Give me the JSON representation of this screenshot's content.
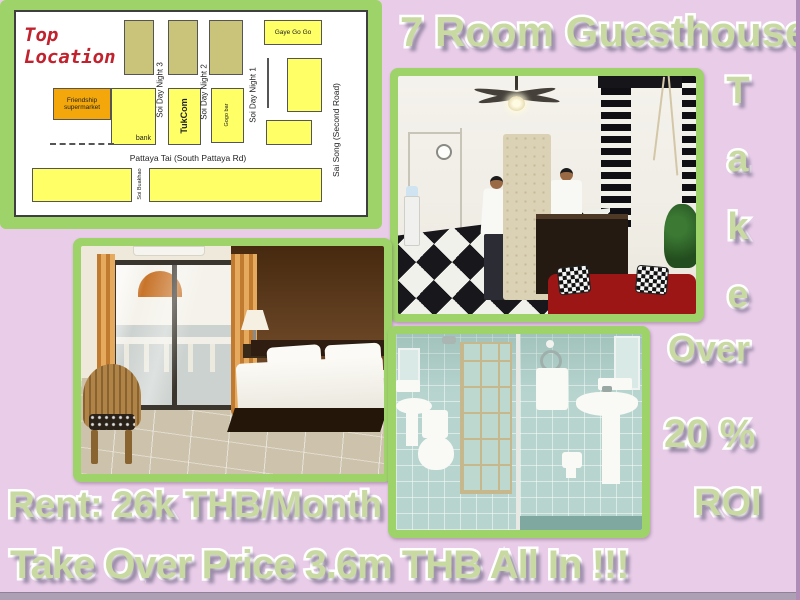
{
  "header": {
    "title": "7 Room Guesthouse"
  },
  "side": {
    "take_letters": [
      "T",
      "a",
      "k",
      "e"
    ],
    "over": "Over",
    "percent": "20 %",
    "roi": "ROI"
  },
  "footer": {
    "rent": "Rent: 26k THB/Month",
    "price": "Take Over Price 3.6m THB All In !!!"
  },
  "map": {
    "title_line1": "Top",
    "title_line2": "Location",
    "labels": {
      "gaye_go_go": "Gaye Go Go",
      "friendship_line1": "Friendship",
      "friendship_line2": "supermarket",
      "bank": "bank",
      "tukcom": "TukCom",
      "gogo_bar": "Gogo bar",
      "soi_day_night_3": "Soi Day Night 3",
      "soi_day_night_2": "Soi Day Night 2",
      "soi_day_night_1": "Soi Day Night 1",
      "pattaya_tai": "Pattaya Tai (South Pattaya Rd)",
      "sai_song": "Sai Song (Second Road)",
      "soi_buakhao": "Soi Buakhao"
    }
  },
  "colors": {
    "background": "#e8cce8",
    "frame_green": "#9ed36a",
    "text_green": "#c9d9a2",
    "map_yellow": "#ffff66",
    "map_olive": "#c9c47a",
    "map_orange": "#f3a70a",
    "map_title_red": "#c2222e"
  }
}
